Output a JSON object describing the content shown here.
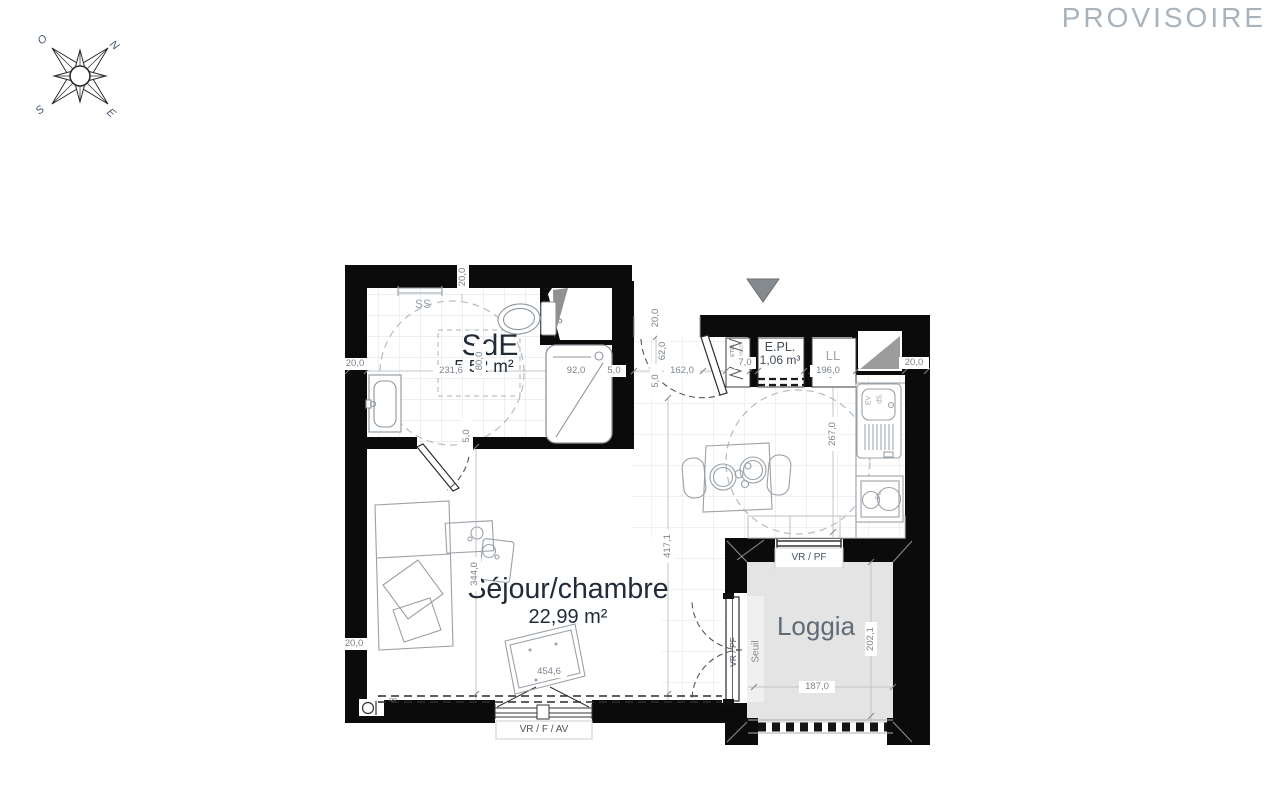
{
  "watermark": "PROVISOIRE",
  "compass": {
    "north": "N",
    "south": "S",
    "east": "E",
    "west": "O"
  },
  "plan": {
    "rooms": {
      "sde": {
        "name": "SdE",
        "area": "5,52 m²"
      },
      "sejour": {
        "name": "Séjour/chambre",
        "area": "22,99 m²"
      },
      "loggia": {
        "name": "Loggia"
      },
      "epl": {
        "name": "E.PL.",
        "volume": "1,06 m³"
      }
    },
    "fixtures": {
      "towel_rail": "SS",
      "washing_machine": "LL",
      "sink": "EV",
      "sink2": "dS.",
      "cooktop": "PL.",
      "etel": "ETEL",
      "etel_size": "60x25",
      "radiator": "RP",
      "threshold": "Seuil"
    },
    "openings": {
      "main_window": "VR / F / AV",
      "loggia_window": "VR / PF",
      "loggia_door": "VR / PF"
    },
    "dims": {
      "wall_top": "20,0",
      "wall_left_upper": "20,0",
      "wall_left_lower": "20,0",
      "wall_right": "20,0",
      "sde_width": "231,6",
      "shower_width": "92,0",
      "sde_gap": "5,0",
      "sde_clear": "80,0",
      "sde_door_gap": "5,0",
      "entry_wall": "20,0",
      "entry_door": "62,0",
      "entry_gap": "5,0",
      "entry_width": "162,0",
      "etel_width": "7,0",
      "kitchen_width": "196,0",
      "kitchen_depth": "267,0",
      "sejour_height": "417,1",
      "sejour_left_height": "344,0",
      "rug_width": "454,6",
      "loggia_width": "187,0",
      "loggia_depth": "202,1"
    }
  }
}
